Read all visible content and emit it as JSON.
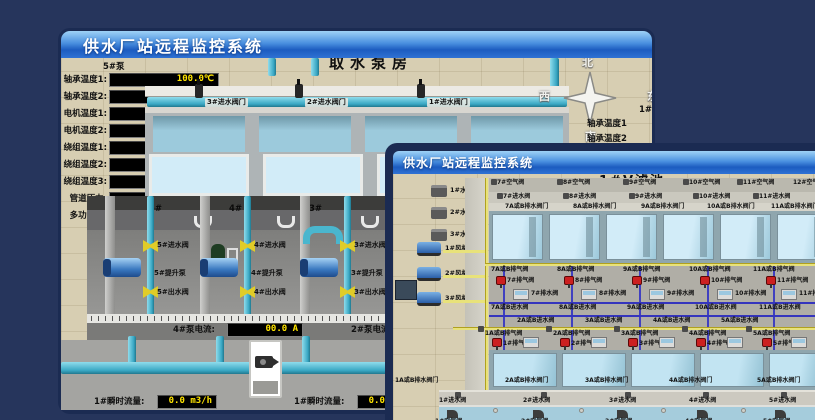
{
  "colors": {
    "desktop": "#26355c",
    "titlebar_top": "#9ed2f6",
    "titlebar_bottom": "#2f72d4",
    "scene_background": "#d7ceb2",
    "lcd_text": "#ffe400",
    "pipe_cyan": "#3aa8c4",
    "valve_yellow": "#e0cc28",
    "valve_red": "#cc2020",
    "water_blue": "#c2e4f2"
  },
  "back": {
    "title": "供水厂站远程监控系统",
    "scene_title": "取水泵房",
    "pump_panel_title": "5#泵",
    "panel_rows": [
      {
        "label": "轴承温度1:",
        "value": "100.0℃"
      },
      {
        "label": "轴承温度2:",
        "value": "100.0℃"
      },
      {
        "label": "电机温度1:",
        "value": "18.1℃"
      },
      {
        "label": "电机温度2:",
        "value": "17.9℃"
      },
      {
        "label": "绕组温度1:",
        "value": "18.0℃"
      },
      {
        "label": "绕组温度2:",
        "value": "18.1℃"
      },
      {
        "label": "绕组温度3:",
        "value": "18.1℃"
      },
      {
        "label": "管道压力:",
        "value": "0.0007MPa"
      },
      {
        "label": "多功能阀:",
        "value": "0%"
      }
    ],
    "inlet_valves": [
      "3#进水阀门",
      "2#进水阀门",
      "1#进水阀门"
    ],
    "compass": {
      "north": "北",
      "west": "西",
      "south": "南",
      "east": "东"
    },
    "right_panel": {
      "title": "1#",
      "labels": [
        "轴承温度1",
        "轴承温度2"
      ]
    },
    "wall_numbers": [
      "5#",
      "4#",
      "3#",
      "2#"
    ],
    "bays": [
      {
        "inlet": "5#进水阀",
        "pump": "5#提升泵",
        "outlet": "5#出水阀"
      },
      {
        "inlet": "4#进水阀",
        "pump": "4#提升泵",
        "outlet": "4#出水阀"
      },
      {
        "inlet": "3#进水阀",
        "pump": "3#提升泵",
        "outlet": "3#出水阀"
      }
    ],
    "current_left": {
      "label": "4#泵电流:",
      "value": "00.0 A"
    },
    "current_right_label": "2#泵电流",
    "flow_left": {
      "label": "1#瞬时流量:",
      "value": "0.0 m3/h"
    },
    "flow_right": {
      "label": "1#瞬时流量:",
      "value": "0.0 m3/h"
    }
  },
  "front": {
    "title": "供水厂站远程监控系统",
    "scene_title": "1#V滤池",
    "pumps": [
      "1#水泵",
      "2#水泵",
      "3#水泵"
    ],
    "blowers": [
      "1#风机",
      "2#风机",
      "3#风机"
    ],
    "top_air_valves": [
      "7#空气阀",
      "8#空气阀",
      "9#空气阀",
      "10#空气阀",
      "11#空气阀",
      "12#空气阀"
    ],
    "top_inlet_valves": [
      "7#进水阀",
      "8#进水阀",
      "9#进水阀",
      "10#进水阀",
      "11#进水阀"
    ],
    "top_drain_valves": [
      "7A或B排水阀门",
      "8A或B排水阀门",
      "9A或B排水阀门",
      "10A或B排水阀门",
      "11A或B排水阀门"
    ],
    "upper_air_pipe_valves": [
      "7A或B排气阀",
      "8A或B排气阀",
      "9A或B排气阀",
      "10A或B排气阀",
      "11A或B排气阀"
    ],
    "upper_exhaust_valves": [
      "7#排气阀",
      "8#排气阀",
      "9#排气阀",
      "10#排气阀",
      "11#排气阀"
    ],
    "upper_drain_boxes": [
      "7#排水阀",
      "8#排水阀",
      "9#排水阀",
      "10#排水阀",
      "11#排水阀"
    ],
    "mid_inlet_upper": [
      "7A或B进水阀",
      "8A或B进水阀",
      "9A或B进水阀",
      "10A或B进水阀",
      "11A或B进水阀"
    ],
    "mid_inlet_lower": [
      "2A或B进水阀",
      "3A或B进水阀",
      "4A或B进水阀",
      "5A或B进水阀"
    ],
    "lower_air_pipe_valves": [
      "1A或B排气阀",
      "2A或B排气阀",
      "3A或B排气阀",
      "4A或B排气阀",
      "5A或B排气阀"
    ],
    "lower_exhaust_valves": [
      "1#排气阀",
      "2#排气阀",
      "3#排气阀",
      "4#排气阀",
      "5#排气阀"
    ],
    "lower_drain_valves": [
      "1A或B排水阀门",
      "2A或B排水阀门",
      "3A或B排水阀门",
      "4A或B排水阀门",
      "5A或B排水阀门"
    ],
    "lower_inlet_valves": [
      "1#进水阀",
      "2#进水阀",
      "3#进水阀",
      "4#进水阀",
      "5#进水阀"
    ],
    "bottom_air_valves": [
      "1#空气阀",
      "2#空气阀",
      "3#空气阀",
      "4#空气阀",
      "5#空气阀"
    ]
  }
}
